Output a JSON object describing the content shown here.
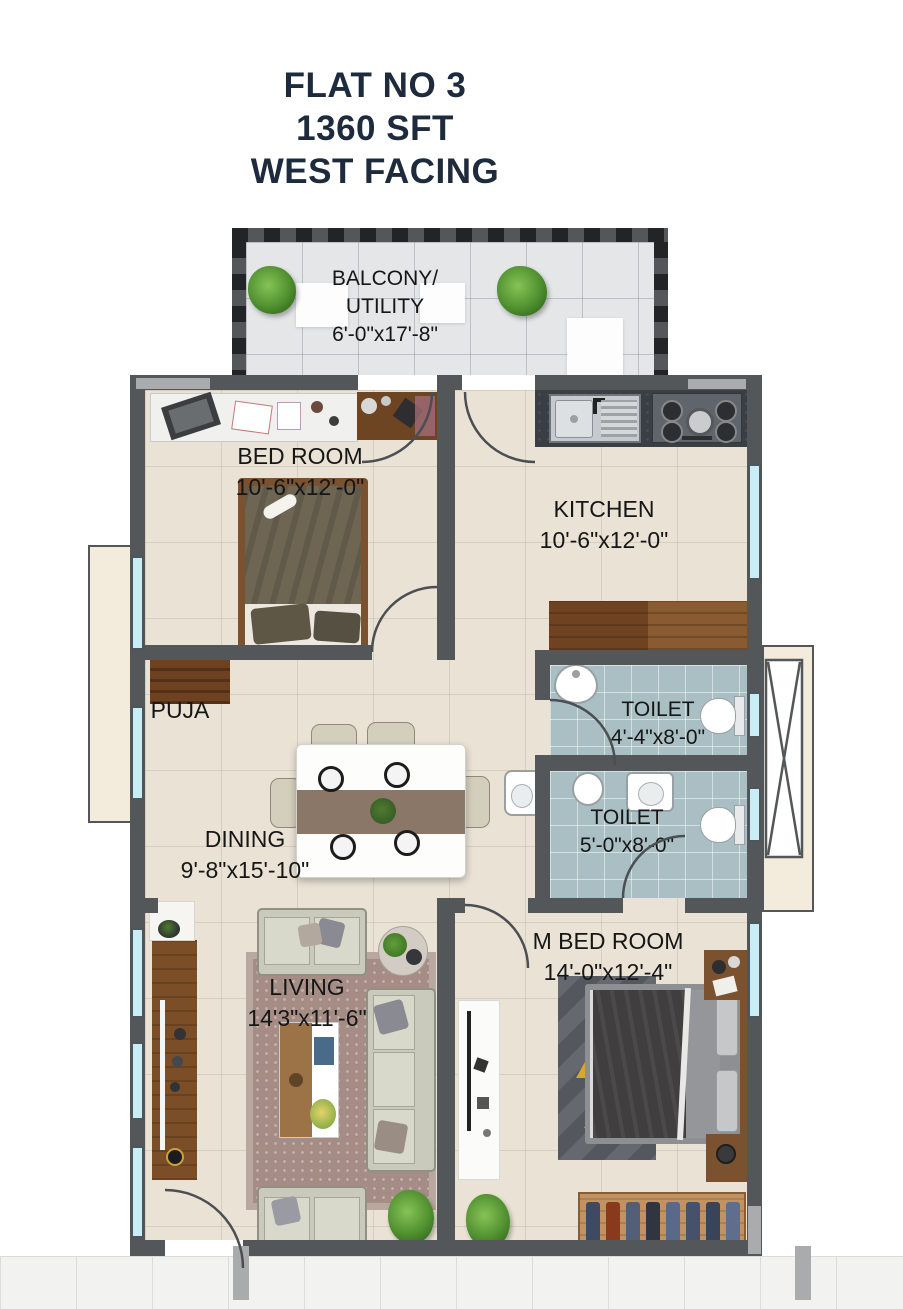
{
  "title": {
    "line1": "FLAT NO 3",
    "line2": "1360 SFT",
    "line3": "WEST FACING"
  },
  "rooms": {
    "balcony": {
      "label_line1": "BALCONY/",
      "label_line2": "UTILITY",
      "dims": "6'-0\"x17'-8\""
    },
    "bedroom": {
      "label": "BED ROOM",
      "dims": "10'-6\"x12'-0\""
    },
    "kitchen": {
      "label": "KITCHEN",
      "dims": "10'-6\"x12'-0\""
    },
    "toilet_top": {
      "label": "TOILET",
      "dims": "4'-4\"x8'-0\""
    },
    "toilet_bottom": {
      "label": "TOILET",
      "dims": "5'-0\"x8'-0\""
    },
    "puja": {
      "label": "PUJA"
    },
    "dining": {
      "label": "DINING",
      "dims": "9'-8\"x15'-10\""
    },
    "living": {
      "label": "LIVING",
      "dims": "14'3\"x11'-6\""
    },
    "master_bedroom": {
      "label": "M BED ROOM",
      "dims": "14'-0\"x12'-4\""
    }
  },
  "colors": {
    "title_text": "#1e2b3d",
    "wall": "#54575a",
    "wall_light": "#a9abad",
    "floor_beige": "#eae3d5",
    "toilet_tile": "#a9bfc3",
    "window_glass": "#c8edf5",
    "wood": "#8a5c35",
    "shaft_beige": "#f3ecdd"
  }
}
